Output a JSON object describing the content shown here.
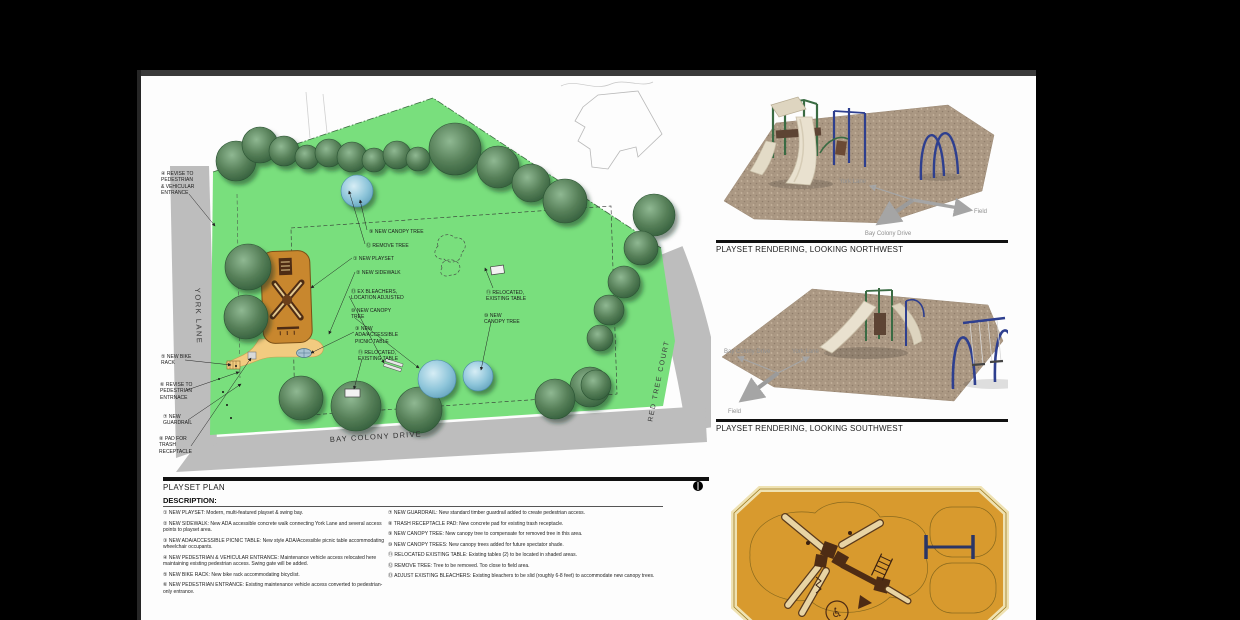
{
  "document": {
    "plan": {
      "title": "PLAYSET PLAN",
      "road_labels": {
        "left_road": "YORK LANE",
        "bottom_road": "BAY COLONY DRIVE",
        "right_road": "RED TREE COURT"
      },
      "callouts": [
        {
          "num": 4,
          "text": "REVISE TO\nPEDESTRIAN\n& VEHICULAR\nENTRANCE"
        },
        {
          "num": 5,
          "text": "NEW BIKE\nRACK"
        },
        {
          "num": 6,
          "text": "REVISE TO\nPEDESTRIAN\nENTRNACE"
        },
        {
          "num": 7,
          "text": "NEW\nGUARDRAIL"
        },
        {
          "num": 8,
          "text": "PAD FOR\nTRASH\nRECEPTACLE"
        },
        {
          "num": 9,
          "text": "NEW CANOPY TREE"
        },
        {
          "num": 12,
          "text": "REMOVE TREE"
        },
        {
          "num": 1,
          "text": "NEW PLAYSET"
        },
        {
          "num": 2,
          "text": "NEW SIDEWALK"
        },
        {
          "num": 13,
          "text": "EX BLEACHERS,\nLOCATION ADJUSTED"
        },
        {
          "num": 10,
          "text": "NEW CANOPY\nTREE"
        },
        {
          "num": 3,
          "text": "NEW\nADA/ACCESSIBLE\nPICNIC TABLE"
        },
        {
          "num": 11,
          "text": "RELOCATED,\nEXISTING TABLE"
        },
        {
          "num": 11,
          "text": "RELOCATED,\nEXISTING TABLE"
        },
        {
          "num": 10,
          "text": "NEW\nCANOPY TREE"
        }
      ]
    },
    "description": {
      "heading": "DESCRIPTION:",
      "items_left": [
        {
          "num": 1,
          "text": "NEW PLAYSET: Modern, multi-featured playset & swing bay."
        },
        {
          "num": 2,
          "text": "NEW SIDEWALK: New ADA accessible concrete walk connecting York Lane and several access points to playset area."
        },
        {
          "num": 3,
          "text": "NEW ADA/ACCESSIBLE PICNIC TABLE: New style ADA/Accessible picnic table accommodating wheelchair occupants."
        },
        {
          "num": 4,
          "text": "NEW PEDESTRIAN & VEHICULAR ENTRANCE: Maintenance vehicle access relocated here maintaining existing pedestrian access. Swing gate will be added."
        },
        {
          "num": 5,
          "text": "NEW BIKE RACK: New bike rack accommodating bicyclist."
        },
        {
          "num": 6,
          "text": "NEW PEDESTRIAN ENTRANCE: Existing maintenance vehicle access converted to pedestrian-only entrance."
        }
      ],
      "items_right": [
        {
          "num": 7,
          "text": "NEW GUARDRAIL: New standard timber guardrail added to create pedestrian access."
        },
        {
          "num": 8,
          "text": "TRASH RECEPTACLE PAD: New concrete pad for existing trash receptacle."
        },
        {
          "num": 9,
          "text": "NEW CANOPY TREE: New canopy tree to compensate for removed tree in this area."
        },
        {
          "num": 10,
          "text": "NEW CANOPY TREES: New canopy trees added for future spectator shade."
        },
        {
          "num": 11,
          "text": "RELOCATED EXISTING TABLE: Existing tables (2) to be located in shaded areas."
        },
        {
          "num": 12,
          "text": "REMOVE TREE: Tree to be removed. Too close to field area."
        },
        {
          "num": 13,
          "text": "ADJUST EXISTING BLEACHERS: Existing bleachers to be slid (roughly 6-8 feet) to accommodate new canopy trees."
        }
      ]
    },
    "renderings": [
      {
        "caption": "PLAYSET RENDERING, LOOKING NORTHWEST",
        "compass_labels": [
          "York Lane",
          "Field",
          "Bay Colony Drive"
        ]
      },
      {
        "caption": "PLAYSET RENDERING, LOOKING SOUTHWEST",
        "compass_labels": [
          "Bay Colony Drive",
          "York Lane",
          "Field"
        ]
      }
    ],
    "icons": {
      "north_arrow_icon": "◑",
      "wheelchair_icon": "♿"
    },
    "colors": {
      "field_green": "#79df7d",
      "tree_green": "#4e7d55",
      "tree_green_dark": "#2f5a38",
      "new_tree_blue": "#7fc0d8",
      "road_gray": "#bdbdbd",
      "playset_orange": "#c8872e",
      "walkway_tan": "#f2cb80",
      "detail_plan_orange": "#d89a2e",
      "equipment_brown": "#4e2c14",
      "swing_blue": "#2e3f8f",
      "mulch_tan": "#ab9883",
      "slide_beige": "#e9e1cf"
    }
  }
}
